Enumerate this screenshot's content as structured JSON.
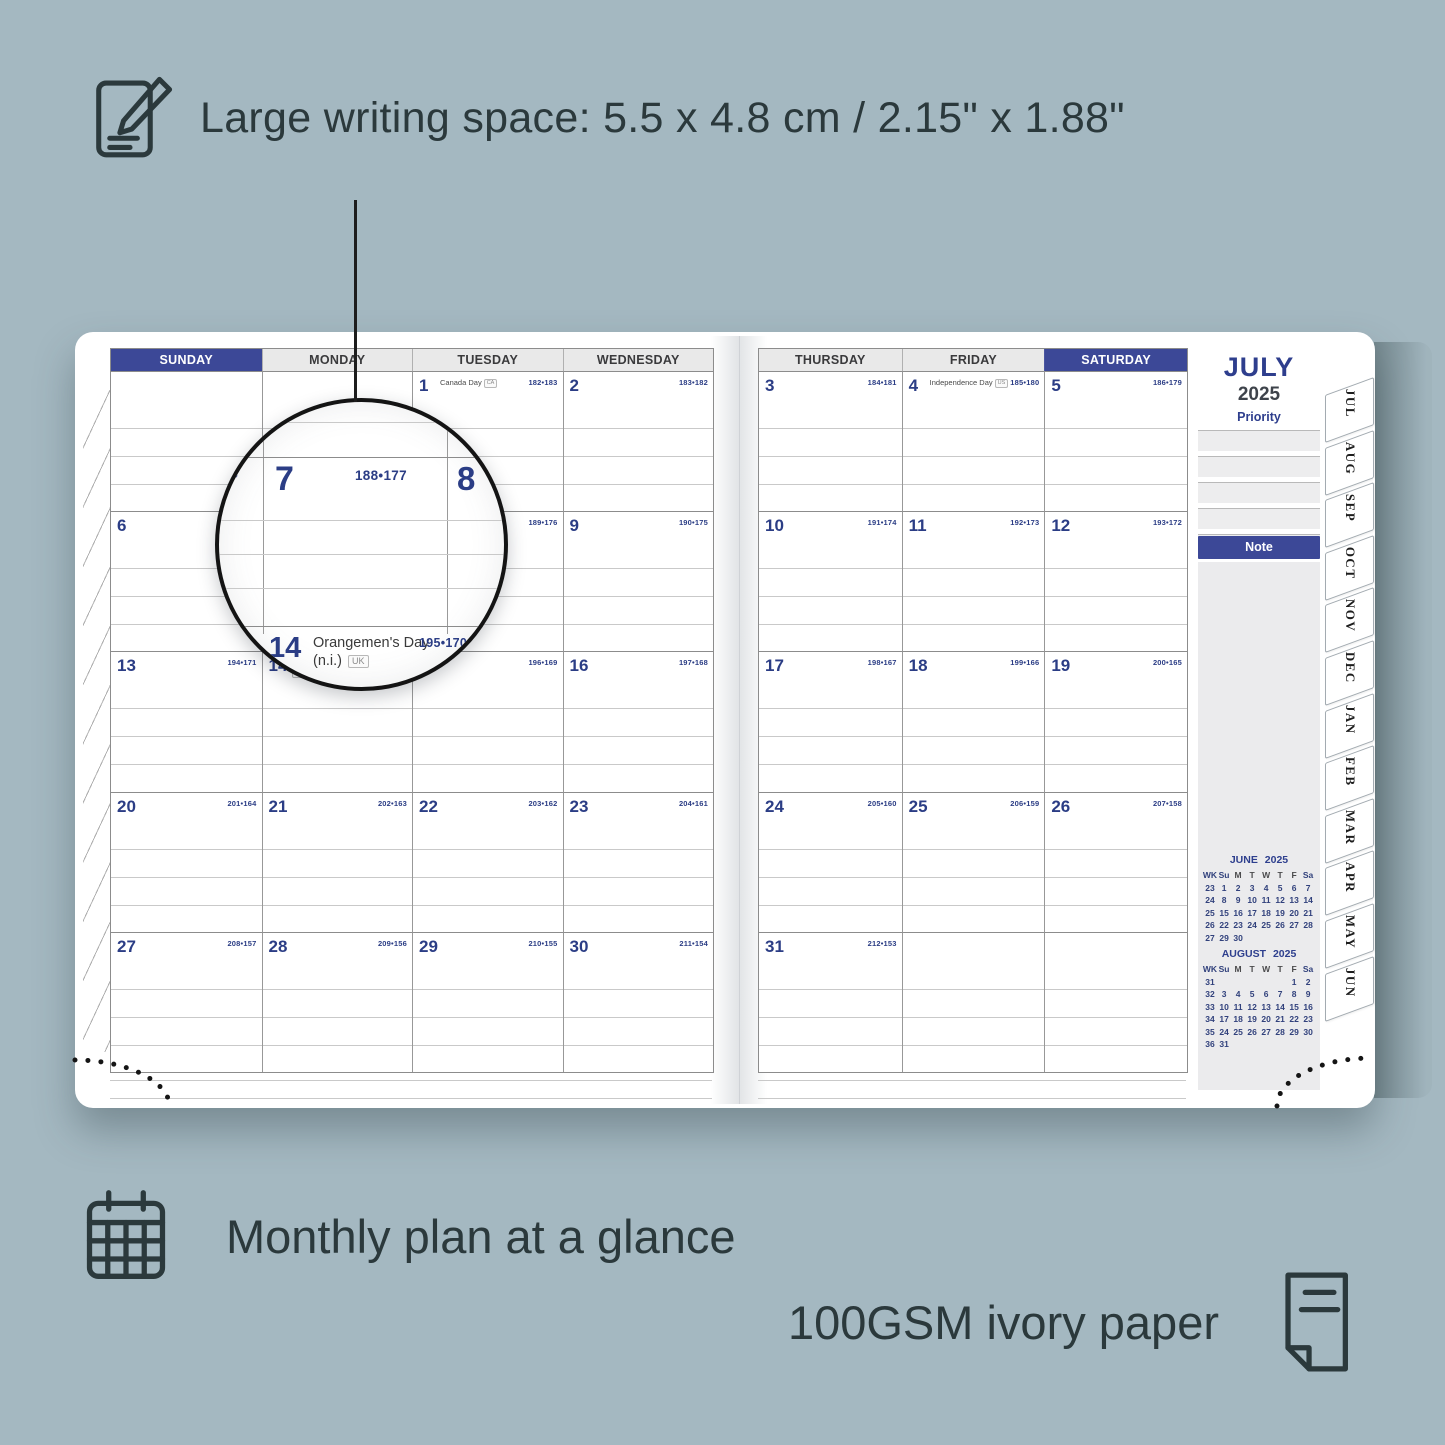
{
  "annotations": {
    "large_writing": "Large writing space: 5.5 x 4.8 cm / 2.15\" x 1.88\"",
    "monthly_plan": "Monthly plan at a glance",
    "paper": "100GSM ivory paper"
  },
  "planner": {
    "month_title": "JULY",
    "year": "2025",
    "sidebar": {
      "priority_label": "Priority",
      "note_label": "Note"
    },
    "left_headers": [
      {
        "label": "SUNDAY",
        "style": "accent"
      },
      {
        "label": "MONDAY",
        "style": "plain"
      },
      {
        "label": "TUESDAY",
        "style": "plain"
      },
      {
        "label": "WEDNESDAY",
        "style": "plain"
      }
    ],
    "right_headers": [
      {
        "label": "THURSDAY",
        "style": "plain"
      },
      {
        "label": "FRIDAY",
        "style": "plain"
      },
      {
        "label": "SATURDAY",
        "style": "accent"
      }
    ],
    "left_weeks": [
      [
        {},
        {},
        {
          "day": "1",
          "code": "182•183",
          "holiday": "Canada Day",
          "flag": "CA"
        },
        {
          "day": "2",
          "code": "183•182"
        }
      ],
      [
        {
          "day": "6",
          "code": "187•178"
        },
        {
          "day": "7",
          "code": "188•177"
        },
        {
          "day": "8",
          "code": "189•176"
        },
        {
          "day": "9",
          "code": "190•175"
        }
      ],
      [
        {
          "day": "13",
          "code": "194•171"
        },
        {
          "day": "14",
          "code": "195•170",
          "holiday": "Orangemen's Day (n.i.)",
          "flag": "UK"
        },
        {
          "day": "15",
          "code": "196•169"
        },
        {
          "day": "16",
          "code": "197•168"
        }
      ],
      [
        {
          "day": "20",
          "code": "201•164"
        },
        {
          "day": "21",
          "code": "202•163"
        },
        {
          "day": "22",
          "code": "203•162"
        },
        {
          "day": "23",
          "code": "204•161"
        }
      ],
      [
        {
          "day": "27",
          "code": "208•157"
        },
        {
          "day": "28",
          "code": "209•156"
        },
        {
          "day": "29",
          "code": "210•155"
        },
        {
          "day": "30",
          "code": "211•154"
        }
      ]
    ],
    "right_weeks": [
      [
        {
          "day": "3",
          "code": "184•181"
        },
        {
          "day": "4",
          "code": "185•180",
          "holiday": "Independence Day",
          "flag": "US"
        },
        {
          "day": "5",
          "code": "186•179"
        }
      ],
      [
        {
          "day": "10",
          "code": "191•174"
        },
        {
          "day": "11",
          "code": "192•173"
        },
        {
          "day": "12",
          "code": "193•172"
        }
      ],
      [
        {
          "day": "17",
          "code": "198•167"
        },
        {
          "day": "18",
          "code": "199•166"
        },
        {
          "day": "19",
          "code": "200•165"
        }
      ],
      [
        {
          "day": "24",
          "code": "205•160"
        },
        {
          "day": "25",
          "code": "206•159"
        },
        {
          "day": "26",
          "code": "207•158"
        }
      ],
      [
        {
          "day": "31",
          "code": "212•153"
        },
        {},
        {}
      ]
    ],
    "tabs": [
      "JUL",
      "AUG",
      "SEP",
      "OCT",
      "NOV",
      "DEC",
      "JAN",
      "FEB",
      "MAR",
      "APR",
      "MAY",
      "JUN"
    ],
    "mini_calendars": [
      {
        "title": "JUNE 2025",
        "headers": [
          "WK",
          "Su",
          "M",
          "T",
          "W",
          "T",
          "F",
          "Sa"
        ],
        "rows": [
          [
            "23",
            "1",
            "2",
            "3",
            "4",
            "5",
            "6",
            "7"
          ],
          [
            "24",
            "8",
            "9",
            "10",
            "11",
            "12",
            "13",
            "14"
          ],
          [
            "25",
            "15",
            "16",
            "17",
            "18",
            "19",
            "20",
            "21"
          ],
          [
            "26",
            "22",
            "23",
            "24",
            "25",
            "26",
            "27",
            "28"
          ],
          [
            "27",
            "29",
            "30",
            "",
            "",
            "",
            "",
            ""
          ]
        ]
      },
      {
        "title": "AUGUST 2025",
        "headers": [
          "WK",
          "Su",
          "M",
          "T",
          "W",
          "T",
          "F",
          "Sa"
        ],
        "rows": [
          [
            "31",
            "",
            "",
            "",
            "",
            "",
            "1",
            "2"
          ],
          [
            "32",
            "3",
            "4",
            "5",
            "6",
            "7",
            "8",
            "9"
          ],
          [
            "33",
            "10",
            "11",
            "12",
            "13",
            "14",
            "15",
            "16"
          ],
          [
            "34",
            "17",
            "18",
            "19",
            "20",
            "21",
            "22",
            "23"
          ],
          [
            "35",
            "24",
            "25",
            "26",
            "27",
            "28",
            "29",
            "30"
          ],
          [
            "36",
            "31",
            "",
            "",
            "",
            "",
            "",
            ""
          ]
        ]
      }
    ],
    "magnifier": {
      "frag": "78",
      "day7": "7",
      "code7": "188•177",
      "day8": "8",
      "day14": "14",
      "holiday14": "Orangemen's Day",
      "holiday14b": "(n.i.)",
      "flag14": "UK",
      "code14": "195•170"
    }
  }
}
